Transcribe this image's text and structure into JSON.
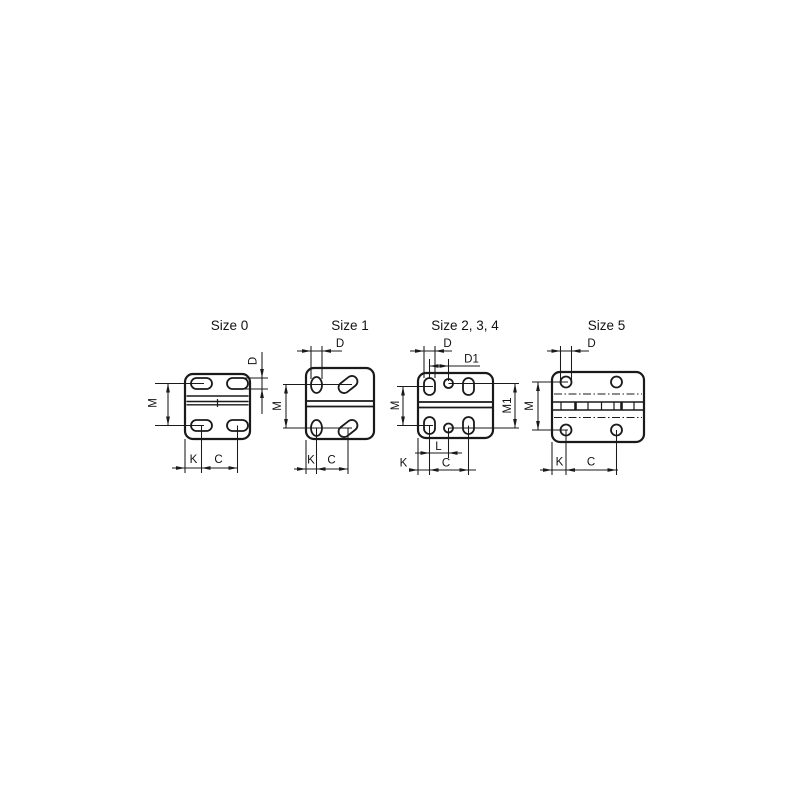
{
  "canvas": {
    "background": "#ffffff",
    "line_color": "#1a1a1a",
    "width": 800,
    "height": 800
  },
  "drawings": [
    {
      "id": "size-0",
      "title": "Size 0",
      "labels": {
        "d": "D",
        "m": "M",
        "k": "K",
        "c": "C"
      }
    },
    {
      "id": "size-1",
      "title": "Size 1",
      "labels": {
        "d": "D",
        "m": "M",
        "k": "K",
        "c": "C"
      }
    },
    {
      "id": "size-2-3-4",
      "title": "Size 2, 3, 4",
      "labels": {
        "d": "D",
        "d1": "D1",
        "m": "M",
        "m1": "M1",
        "l": "L",
        "k": "K",
        "c": "C"
      }
    },
    {
      "id": "size-5",
      "title": "Size 5",
      "labels": {
        "d": "D",
        "m": "M",
        "k": "K",
        "c": "C"
      }
    }
  ]
}
